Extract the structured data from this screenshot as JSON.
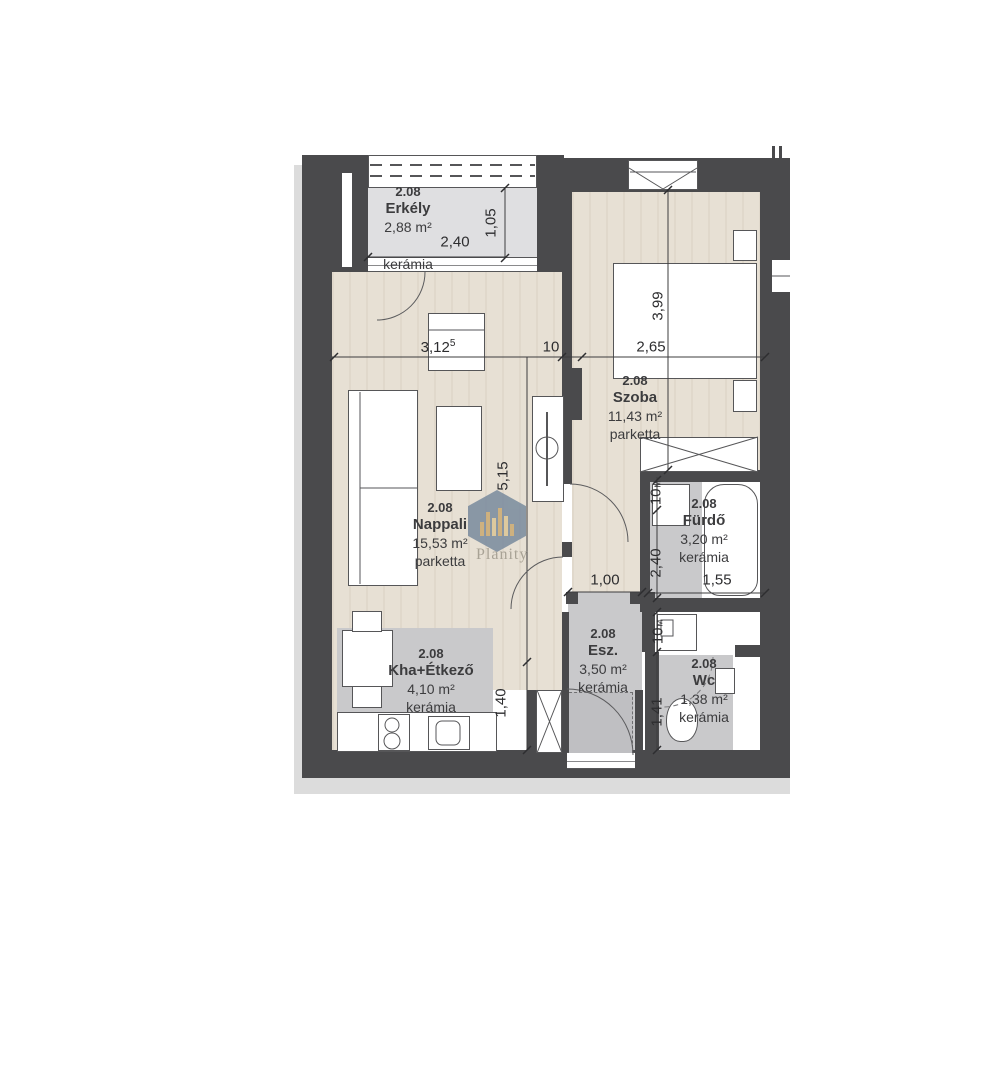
{
  "watermark": {
    "brand": "Planity"
  },
  "rooms": {
    "erkely": {
      "unit": "2.08",
      "name": "Erkély",
      "area": "2,88 m²",
      "floor": "kerámia"
    },
    "szoba": {
      "unit": "2.08",
      "name": "Szoba",
      "area": "11,43 m²",
      "floor": "parketta"
    },
    "nappali": {
      "unit": "2.08",
      "name": "Nappali",
      "area": "15,53 m²",
      "floor": "parketta"
    },
    "furdo": {
      "unit": "2.08",
      "name": "Fürdő",
      "area": "3,20 m²",
      "floor": "kerámia"
    },
    "esz": {
      "unit": "2.08",
      "name": "Esz.",
      "area": "3,50 m²",
      "floor": "kerámia"
    },
    "kha": {
      "unit": "2.08",
      "name": "Kha+Étkező",
      "area": "4,10 m²",
      "floor": "kerámia"
    },
    "wc": {
      "unit": "2.08",
      "name": "Wc",
      "area": "1,38 m²",
      "floor": "kerámia"
    }
  },
  "dimensions": {
    "erkely_width": "2,40",
    "erkely_depth": "1,05",
    "nappali_width": "3,12",
    "nappali_width_sup": "5",
    "wall_thickness": "10",
    "wall_marker": "M",
    "nappali_length": "5,15",
    "szoba_width": "2,65",
    "szoba_length": "3,99",
    "furdo_length": "2,40",
    "furdo_width": "1,55",
    "esz_width": "1,00",
    "kha_length": "1,40",
    "wc_length": "1,41"
  },
  "colors": {
    "wall": "#4a4a4c",
    "parquet_floor": "#e7e0d4",
    "ceramic_floor": "#c9c9cb",
    "balcony_floor": "#dfdfe1",
    "watermark_badge": "#74879b",
    "watermark_gold": "#c9a76d"
  }
}
